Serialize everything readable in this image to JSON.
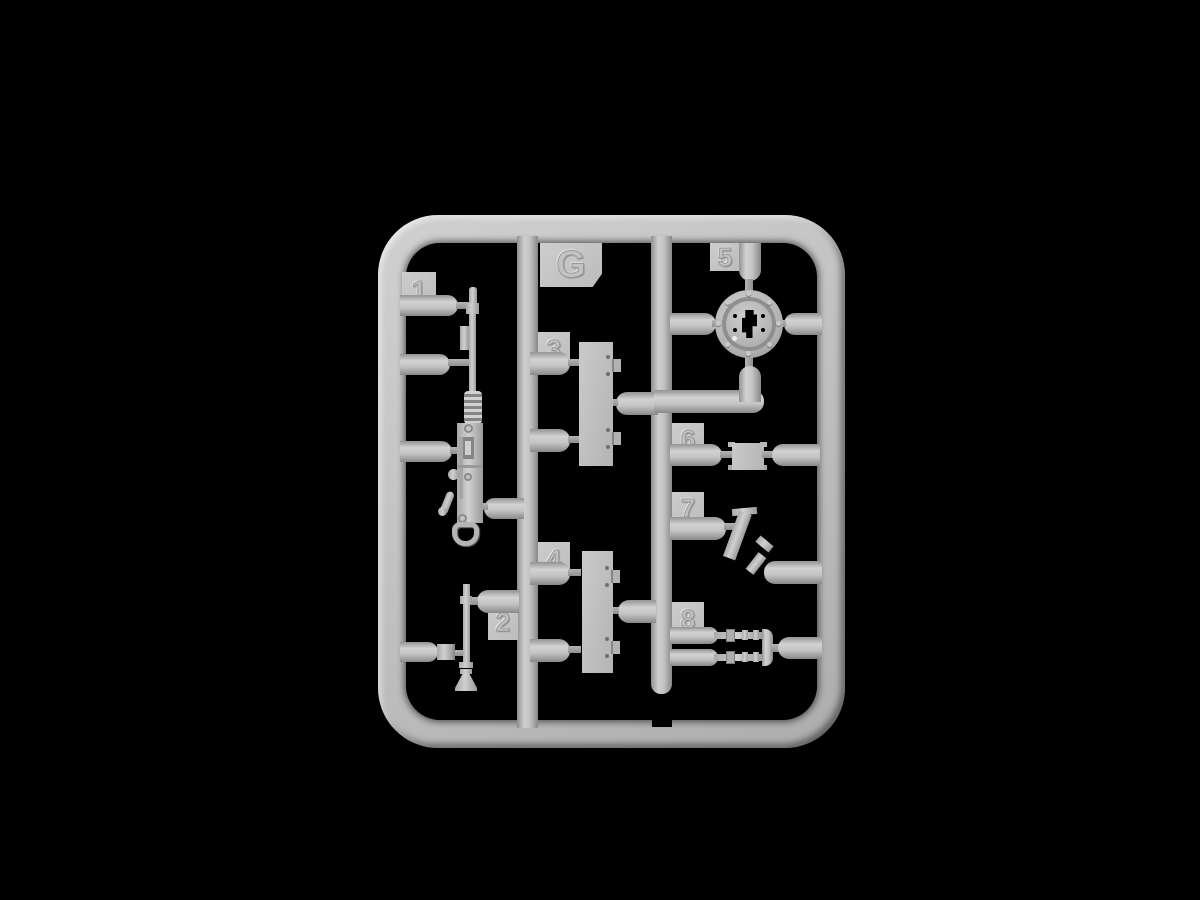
{
  "scene": {
    "background_color": "#000000",
    "subject": "plastic-model-sprue"
  },
  "sprue": {
    "letter_label": "G",
    "plastic_color": "#c2c2c2",
    "highlight_color": "#d4d4d4",
    "shadow_color": "#8a8a8a",
    "parts": [
      {
        "number": "1",
        "name": "machine-gun"
      },
      {
        "number": "2",
        "name": "gun-barrel"
      },
      {
        "number": "3",
        "name": "hatch-plate"
      },
      {
        "number": "4",
        "name": "hatch-plate"
      },
      {
        "number": "5",
        "name": "mount-ring"
      },
      {
        "number": "6",
        "name": "coupler-block"
      },
      {
        "number": "7",
        "name": "angled-bracket"
      },
      {
        "number": "8",
        "name": "twin-rods"
      }
    ]
  }
}
